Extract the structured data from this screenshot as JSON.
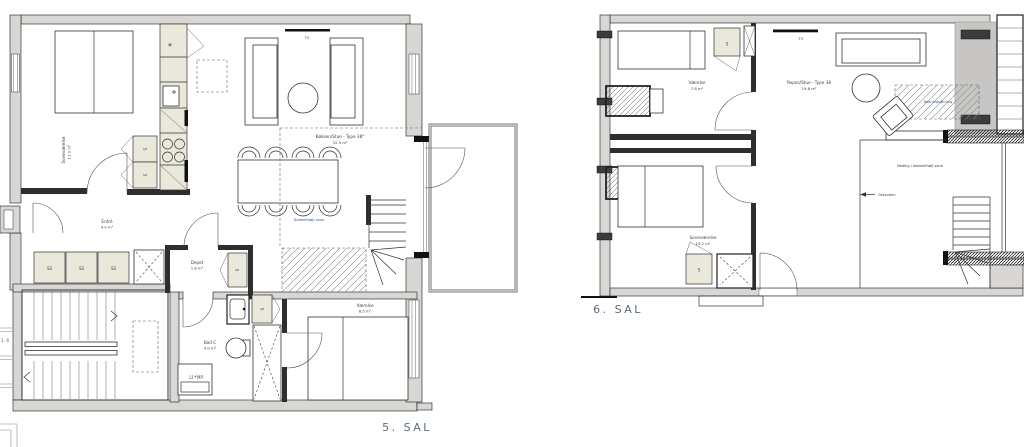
{
  "colors": {
    "wall_fill": "#d8d7d4",
    "cabinet_fill": "#eae7db",
    "room_label": "#3d4147",
    "zone_label": "#2e5c8e",
    "floor_label": "#566b7d"
  },
  "plan5": {
    "floor_label": "5. SAL",
    "rooms": {
      "bedroom": {
        "name": "Soveværelse",
        "area": "11.0 m²"
      },
      "kitchen_living": {
        "name": "Køkken/Stue - Type 38*",
        "area": "32.9 m²"
      },
      "entry": {
        "name": "Entré",
        "area": "4.0 m²"
      },
      "storage": {
        "name": "Depot",
        "area": "1.8 m²"
      },
      "bath": {
        "name": "Bad C",
        "area": "4.0 m²"
      },
      "room": {
        "name": "Værelse",
        "area": "8.5 m²"
      }
    },
    "labels": {
      "tv": "TV",
      "double_height_zone": "Dobbelthøjt zone",
      "washer_dryer": "VM+TT",
      "wardrobe": "S",
      "wardrobe_double": "SS",
      "freezer_symbol": "*"
    }
  },
  "plan6": {
    "floor_label": "6. SAL",
    "rooms": {
      "room": {
        "name": "Værelse",
        "area": "7.8 m²"
      },
      "landing_living": {
        "name": "Repos/Stue - Type 38",
        "area": "19.8 m²"
      },
      "bedroom": {
        "name": "Soveværelse",
        "area": "10.2 m²"
      }
    },
    "labels": {
      "tv": "TV",
      "void_zone": "Nedkig i dobbelthøjt zone",
      "glass_railing": "Glasværn",
      "rescue_opening": "Redningsåbning",
      "wardrobe": "S"
    }
  },
  "edge": {
    "cutoff_label": "1. 6"
  }
}
